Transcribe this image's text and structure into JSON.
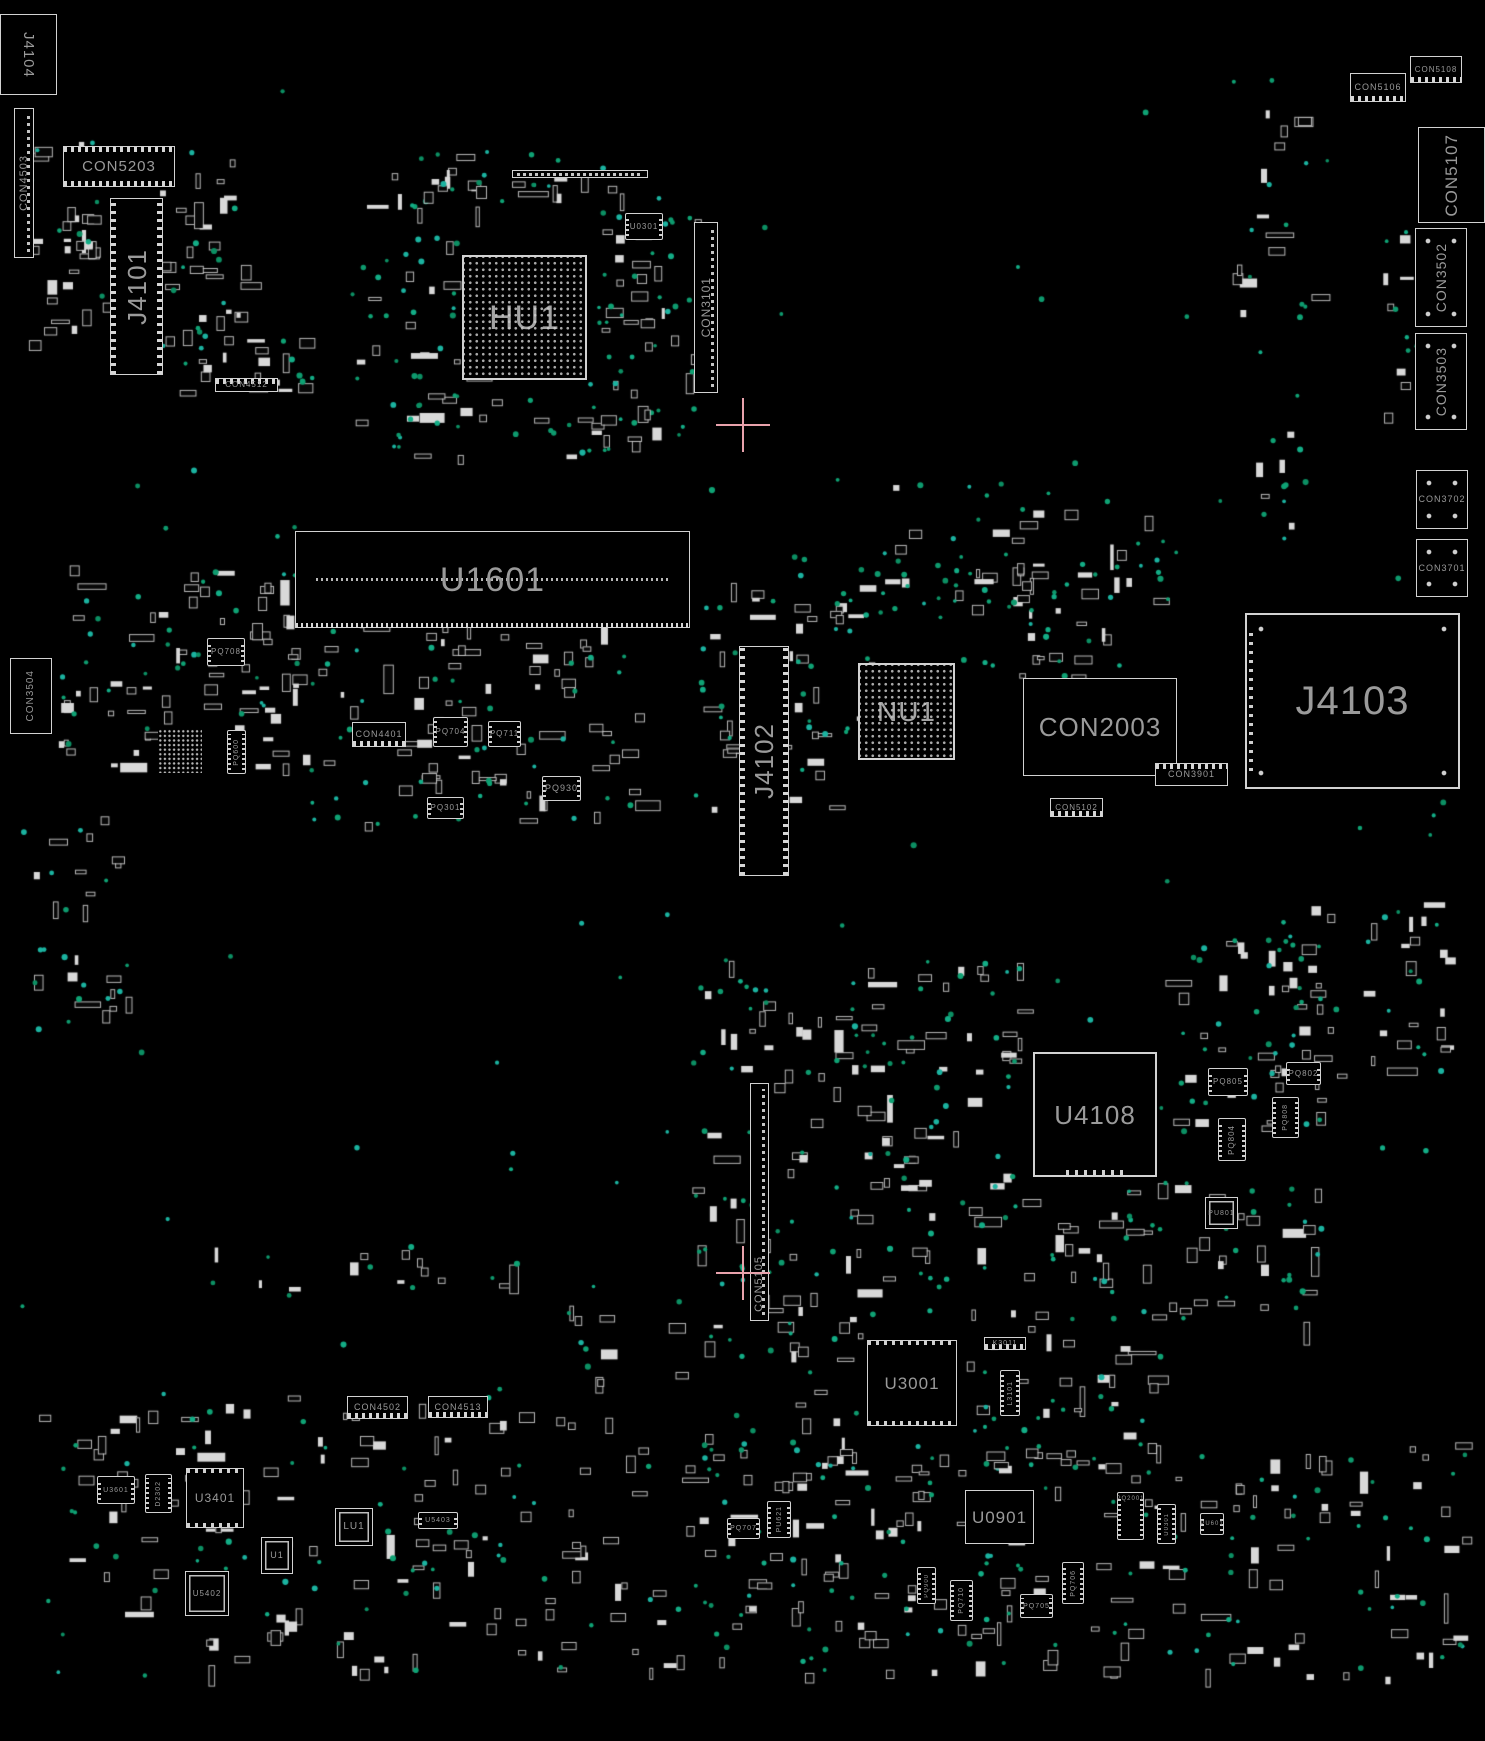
{
  "meta": {
    "view": "pcb-boardview-top",
    "background_color": "#000000",
    "outline_color": "#d2d2d2",
    "label_color": "#9a9a9a",
    "testpoint_color": "#0fa274",
    "crosshair_color": "#e8a2ac"
  },
  "components": [
    {
      "id": "J4104",
      "label": "J4104",
      "x": 0,
      "y": 14,
      "w": 57,
      "h": 81,
      "type": "box",
      "orient": "vcw",
      "fs": 15
    },
    {
      "id": "CON4503",
      "label": "CON4503",
      "x": 14,
      "y": 108,
      "w": 20,
      "h": 150,
      "type": "stripv",
      "orient": "v",
      "fs": 11
    },
    {
      "id": "CON5203",
      "label": "CON5203",
      "x": 63,
      "y": 146,
      "w": 112,
      "h": 41,
      "type": "connh",
      "orient": "h",
      "fs": 15
    },
    {
      "id": "J4101",
      "label": "J4101",
      "x": 110,
      "y": 198,
      "w": 53,
      "h": 177,
      "type": "connv",
      "orient": "v",
      "fs": 26
    },
    {
      "id": "CON4512",
      "label": "CON4512",
      "x": 215,
      "y": 378,
      "w": 63,
      "h": 14,
      "type": "connht",
      "orient": "h",
      "fs": 8
    },
    {
      "id": "HU1",
      "label": "HU1",
      "x": 462,
      "y": 255,
      "w": 125,
      "h": 125,
      "type": "bga",
      "orient": "h",
      "fs": 34
    },
    {
      "id": "U0301",
      "label": "U0301",
      "x": 625,
      "y": 213,
      "w": 38,
      "h": 27,
      "type": "ic",
      "orient": "h",
      "fs": 8
    },
    {
      "id": "STRIP1",
      "label": "",
      "x": 512,
      "y": 170,
      "w": 136,
      "h": 8,
      "type": "striph",
      "orient": "h",
      "fs": 0
    },
    {
      "id": "CON3101",
      "label": "CON3101",
      "x": 694,
      "y": 222,
      "w": 24,
      "h": 171,
      "type": "stripv",
      "orient": "v",
      "fs": 12
    },
    {
      "id": "CON5106",
      "label": "CON5106",
      "x": 1350,
      "y": 73,
      "w": 56,
      "h": 29,
      "type": "connhb",
      "orient": "h",
      "fs": 9
    },
    {
      "id": "CON5108",
      "label": "CON5108",
      "x": 1410,
      "y": 56,
      "w": 52,
      "h": 27,
      "type": "connhb",
      "orient": "h",
      "fs": 8
    },
    {
      "id": "CON5107",
      "label": "CON5107",
      "x": 1418,
      "y": 127,
      "w": 67,
      "h": 96,
      "type": "box",
      "orient": "v",
      "fs": 17
    },
    {
      "id": "CON3502",
      "label": "CON3502",
      "x": 1415,
      "y": 228,
      "w": 52,
      "h": 99,
      "type": "boxd",
      "orient": "v",
      "fs": 14
    },
    {
      "id": "CON3503",
      "label": "CON3503",
      "x": 1415,
      "y": 333,
      "w": 52,
      "h": 97,
      "type": "boxd",
      "orient": "v",
      "fs": 14
    },
    {
      "id": "CON3702",
      "label": "CON3702",
      "x": 1416,
      "y": 470,
      "w": 52,
      "h": 59,
      "type": "boxd",
      "orient": "h",
      "fs": 9
    },
    {
      "id": "CON3701",
      "label": "CON3701",
      "x": 1416,
      "y": 539,
      "w": 52,
      "h": 58,
      "type": "boxd",
      "orient": "h",
      "fs": 9
    },
    {
      "id": "U1601",
      "label": "U1601",
      "x": 295,
      "y": 531,
      "w": 395,
      "h": 97,
      "type": "dimm",
      "orient": "h",
      "fs": 34
    },
    {
      "id": "CON3504",
      "label": "CON3504",
      "x": 10,
      "y": 658,
      "w": 42,
      "h": 76,
      "type": "box",
      "orient": "v",
      "fs": 10
    },
    {
      "id": "PQ708",
      "label": "PQ708",
      "x": 207,
      "y": 638,
      "w": 38,
      "h": 28,
      "type": "ic",
      "orient": "h",
      "fs": 8
    },
    {
      "id": "BGA2",
      "label": "",
      "x": 158,
      "y": 729,
      "w": 44,
      "h": 44,
      "type": "bgasm",
      "orient": "h",
      "fs": 0
    },
    {
      "id": "PQ600",
      "label": "PQ600",
      "x": 227,
      "y": 730,
      "w": 19,
      "h": 44,
      "type": "ic",
      "orient": "v",
      "fs": 7
    },
    {
      "id": "CON4401",
      "label": "CON4401",
      "x": 352,
      "y": 722,
      "w": 54,
      "h": 25,
      "type": "connhb",
      "orient": "h",
      "fs": 9
    },
    {
      "id": "PQ704",
      "label": "PQ704",
      "x": 433,
      "y": 717,
      "w": 35,
      "h": 30,
      "type": "ic",
      "orient": "h",
      "fs": 8
    },
    {
      "id": "PQ711",
      "label": "PQ711",
      "x": 488,
      "y": 721,
      "w": 33,
      "h": 26,
      "type": "ic",
      "orient": "h",
      "fs": 8
    },
    {
      "id": "PQ930",
      "label": "PQ930",
      "x": 542,
      "y": 776,
      "w": 39,
      "h": 25,
      "type": "ic",
      "orient": "h",
      "fs": 9
    },
    {
      "id": "PQ301",
      "label": "PQ301",
      "x": 427,
      "y": 797,
      "w": 37,
      "h": 22,
      "type": "ic",
      "orient": "h",
      "fs": 8
    },
    {
      "id": "J4102",
      "label": "J4102",
      "x": 739,
      "y": 646,
      "w": 50,
      "h": 230,
      "type": "connv",
      "orient": "v",
      "fs": 26
    },
    {
      "id": "NU1",
      "label": "NU1",
      "x": 858,
      "y": 663,
      "w": 97,
      "h": 97,
      "type": "bga",
      "orient": "h",
      "fs": 28
    },
    {
      "id": "CON2003",
      "label": "CON2003",
      "x": 1023,
      "y": 678,
      "w": 154,
      "h": 98,
      "type": "box",
      "orient": "h",
      "fs": 26
    },
    {
      "id": "CON3901",
      "label": "CON3901",
      "x": 1155,
      "y": 763,
      "w": 73,
      "h": 23,
      "type": "connht",
      "orient": "h",
      "fs": 9
    },
    {
      "id": "CON5102",
      "label": "CON5102",
      "x": 1050,
      "y": 798,
      "w": 53,
      "h": 19,
      "type": "connhb",
      "orient": "h",
      "fs": 8
    },
    {
      "id": "J4103",
      "label": "J4103",
      "x": 1245,
      "y": 613,
      "w": 215,
      "h": 176,
      "type": "jbig",
      "orient": "h",
      "fs": 40
    },
    {
      "id": "U4108",
      "label": "U4108",
      "x": 1033,
      "y": 1052,
      "w": 124,
      "h": 125,
      "type": "chipbig",
      "orient": "h",
      "fs": 26
    },
    {
      "id": "PQ805",
      "label": "PQ805",
      "x": 1208,
      "y": 1068,
      "w": 40,
      "h": 28,
      "type": "ic",
      "orient": "h",
      "fs": 8
    },
    {
      "id": "PQ802",
      "label": "PQ802",
      "x": 1286,
      "y": 1062,
      "w": 35,
      "h": 23,
      "type": "ic",
      "orient": "h",
      "fs": 8
    },
    {
      "id": "PQ804",
      "label": "PQ804",
      "x": 1218,
      "y": 1118,
      "w": 28,
      "h": 43,
      "type": "ic",
      "orient": "v",
      "fs": 8
    },
    {
      "id": "PQ808",
      "label": "PQ808",
      "x": 1272,
      "y": 1097,
      "w": 27,
      "h": 41,
      "type": "ic",
      "orient": "v",
      "fs": 7
    },
    {
      "id": "PU801",
      "label": "PU801",
      "x": 1205,
      "y": 1197,
      "w": 33,
      "h": 32,
      "type": "chipsm",
      "orient": "h",
      "fs": 7
    },
    {
      "id": "CON5105",
      "label": "CON5105",
      "x": 750,
      "y": 1083,
      "w": 19,
      "h": 238,
      "type": "stripv",
      "orient": "v",
      "fs": 11,
      "lp": "b"
    },
    {
      "id": "U3001",
      "label": "U3001",
      "x": 867,
      "y": 1340,
      "w": 90,
      "h": 86,
      "type": "chip",
      "orient": "h",
      "fs": 17
    },
    {
      "id": "K3011",
      "label": "K3011",
      "x": 984,
      "y": 1337,
      "w": 42,
      "h": 13,
      "type": "connhb",
      "orient": "h",
      "fs": 7
    },
    {
      "id": "L3101",
      "label": "L3101",
      "x": 1000,
      "y": 1370,
      "w": 20,
      "h": 46,
      "type": "ic",
      "orient": "v",
      "fs": 7
    },
    {
      "id": "CON4502",
      "label": "CON4502",
      "x": 347,
      "y": 1396,
      "w": 61,
      "h": 23,
      "type": "connhb",
      "orient": "h",
      "fs": 9
    },
    {
      "id": "CON4513",
      "label": "CON4513",
      "x": 428,
      "y": 1396,
      "w": 60,
      "h": 22,
      "type": "connhb",
      "orient": "h",
      "fs": 9
    },
    {
      "id": "U3601",
      "label": "U3601",
      "x": 97,
      "y": 1476,
      "w": 38,
      "h": 28,
      "type": "ic",
      "orient": "h",
      "fs": 7
    },
    {
      "id": "D2302",
      "label": "D2302",
      "x": 145,
      "y": 1474,
      "w": 27,
      "h": 39,
      "type": "ic",
      "orient": "v",
      "fs": 7
    },
    {
      "id": "U3401",
      "label": "U3401",
      "x": 186,
      "y": 1468,
      "w": 58,
      "h": 60,
      "type": "chip",
      "orient": "h",
      "fs": 12
    },
    {
      "id": "U1",
      "label": "U1",
      "x": 261,
      "y": 1537,
      "w": 32,
      "h": 37,
      "type": "chipsm",
      "orient": "h",
      "fs": 9
    },
    {
      "id": "LU1",
      "label": "LU1",
      "x": 335,
      "y": 1508,
      "w": 38,
      "h": 38,
      "type": "chipsm",
      "orient": "h",
      "fs": 10
    },
    {
      "id": "U5403",
      "label": "U5403",
      "x": 418,
      "y": 1512,
      "w": 40,
      "h": 17,
      "type": "ic",
      "orient": "h",
      "fs": 7
    },
    {
      "id": "U5402",
      "label": "U5402",
      "x": 185,
      "y": 1571,
      "w": 44,
      "h": 45,
      "type": "chipsm",
      "orient": "h",
      "fs": 8
    },
    {
      "id": "PQ707",
      "label": "PQ707",
      "x": 727,
      "y": 1518,
      "w": 33,
      "h": 21,
      "type": "ic",
      "orient": "h",
      "fs": 7
    },
    {
      "id": "PU621",
      "label": "PU621",
      "x": 767,
      "y": 1501,
      "w": 24,
      "h": 37,
      "type": "ic",
      "orient": "v",
      "fs": 7
    },
    {
      "id": "U0901",
      "label": "U0901",
      "x": 965,
      "y": 1490,
      "w": 69,
      "h": 54,
      "type": "box",
      "orient": "h",
      "fs": 17
    },
    {
      "id": "PQ900",
      "label": "PQ900",
      "x": 917,
      "y": 1567,
      "w": 19,
      "h": 37,
      "type": "ic",
      "orient": "v",
      "fs": 6
    },
    {
      "id": "PQ710",
      "label": "PQ710",
      "x": 950,
      "y": 1580,
      "w": 23,
      "h": 41,
      "type": "ic",
      "orient": "v",
      "fs": 7
    },
    {
      "id": "PQ705",
      "label": "PQ705",
      "x": 1020,
      "y": 1594,
      "w": 33,
      "h": 24,
      "type": "ic",
      "orient": "h",
      "fs": 7
    },
    {
      "id": "PQ706",
      "label": "PQ706",
      "x": 1062,
      "y": 1562,
      "w": 22,
      "h": 42,
      "type": "ic",
      "orient": "v",
      "fs": 7
    },
    {
      "id": "PQ2001",
      "label": "PQ2001",
      "x": 1117,
      "y": 1492,
      "w": 27,
      "h": 48,
      "type": "ic",
      "orient": "h",
      "fs": 6,
      "lp": "t"
    },
    {
      "id": "U0301B",
      "label": "U0301",
      "x": 1157,
      "y": 1504,
      "w": 19,
      "h": 40,
      "type": "ic",
      "orient": "v",
      "fs": 6
    },
    {
      "id": "PU601",
      "label": "PU601",
      "x": 1200,
      "y": 1513,
      "w": 24,
      "h": 22,
      "type": "ic",
      "orient": "h",
      "fs": 6
    }
  ],
  "crosshairs": [
    {
      "x": 743,
      "y": 425
    },
    {
      "x": 743,
      "y": 1273
    }
  ],
  "decor": {
    "seed": 7,
    "palette": [
      "#0fa274",
      "#0e9a6e",
      "#1bb3a0",
      "#0c8f63",
      "#13ad86"
    ],
    "sparse_dots": 95,
    "bounds": [
      20,
      60,
      1445,
      1620
    ],
    "clusters": [
      [
        28,
        140,
        215,
        205,
        65,
        22
      ],
      [
        150,
        333,
        160,
        60,
        18,
        8
      ],
      [
        352,
        172,
        115,
        255,
        22,
        26
      ],
      [
        585,
        180,
        115,
        265,
        28,
        30
      ],
      [
        405,
        152,
        200,
        55,
        16,
        14
      ],
      [
        385,
        392,
        300,
        65,
        14,
        24
      ],
      [
        1232,
        78,
        80,
        250,
        14,
        10
      ],
      [
        1382,
        230,
        36,
        185,
        8,
        6
      ],
      [
        1256,
        425,
        56,
        115,
        5,
        8
      ],
      [
        58,
        565,
        240,
        210,
        65,
        28
      ],
      [
        302,
        595,
        335,
        230,
        75,
        38
      ],
      [
        700,
        565,
        175,
        250,
        42,
        28
      ],
      [
        950,
        562,
        175,
        115,
        28,
        22
      ],
      [
        862,
        482,
        300,
        85,
        10,
        14
      ],
      [
        770,
        555,
        180,
        70,
        6,
        18
      ],
      [
        1098,
        540,
        70,
        60,
        4,
        6
      ],
      [
        32,
        812,
        100,
        195,
        14,
        8
      ],
      [
        62,
        950,
        55,
        75,
        5,
        4
      ],
      [
        692,
        952,
        330,
        195,
        55,
        45
      ],
      [
        1162,
        940,
        160,
        195,
        32,
        28
      ],
      [
        1022,
        1182,
        300,
        145,
        42,
        32
      ],
      [
        692,
        1152,
        330,
        175,
        48,
        38
      ],
      [
        1262,
        902,
        195,
        175,
        28,
        18
      ],
      [
        962,
        1332,
        195,
        145,
        28,
        22
      ],
      [
        700,
        1332,
        160,
        145,
        22,
        18
      ],
      [
        32,
        1392,
        595,
        285,
        110,
        55
      ],
      [
        632,
        1442,
        445,
        235,
        85,
        48
      ],
      [
        1082,
        1442,
        385,
        235,
        65,
        38
      ],
      [
        560,
        1285,
        120,
        95,
        8,
        6
      ],
      [
        200,
        1244,
        330,
        55,
        12,
        8
      ]
    ]
  }
}
